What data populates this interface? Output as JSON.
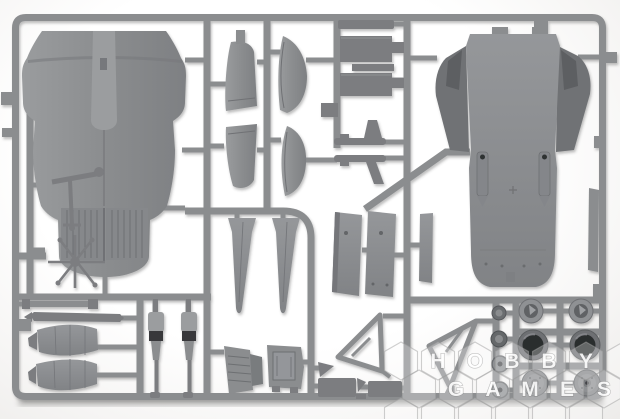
{
  "meta": {
    "description": "Product photograph of a single gray injection-molded plastic sprue (model aircraft kit parts frame) laid on a white background",
    "subject": "model kit sprue with aircraft parts"
  },
  "watermark": {
    "text": "HOBBY GAMES",
    "style": "translucent white honeycomb hexagons with bold letters, bottom-right corner",
    "rows": [
      {
        "letters": [
          "H",
          "O",
          "B",
          "B",
          "Y"
        ]
      },
      {
        "letters": [
          "G",
          "A",
          "M",
          "E",
          "S"
        ]
      }
    ]
  },
  "palette": {
    "plastic": "#8b8d8f",
    "plastic_light": "#9b9d9f",
    "plastic_dark": "#7b7d80",
    "plastic_deep": "#6e7073",
    "flare_dark": "#707275",
    "notch_dark": "#5d5f62",
    "tire": "#2c2d2f",
    "band_dark": "#37383b",
    "shadow": "#8a8a88"
  },
  "parts": [
    "upper-fuselage-half",
    "lower-fuselage-half",
    "vertical-stabilizer-halves",
    "rudder-halves",
    "airbrake-box-panels",
    "equipment-boxes",
    "pylon-missile-bodies",
    "inner-flap-panels",
    "narrow-side-panel",
    "exhaust-nozzle-petals",
    "push-rods",
    "main-landing-gear-struts",
    "gear-bay-brackets",
    "gear-retraction-frames",
    "access-door-panels",
    "wheel-hubs",
    "tires",
    "main-wheels",
    "small-hub-discs",
    "landing-light-arm",
    "antenna-cluster",
    "drop-tank-halves"
  ]
}
